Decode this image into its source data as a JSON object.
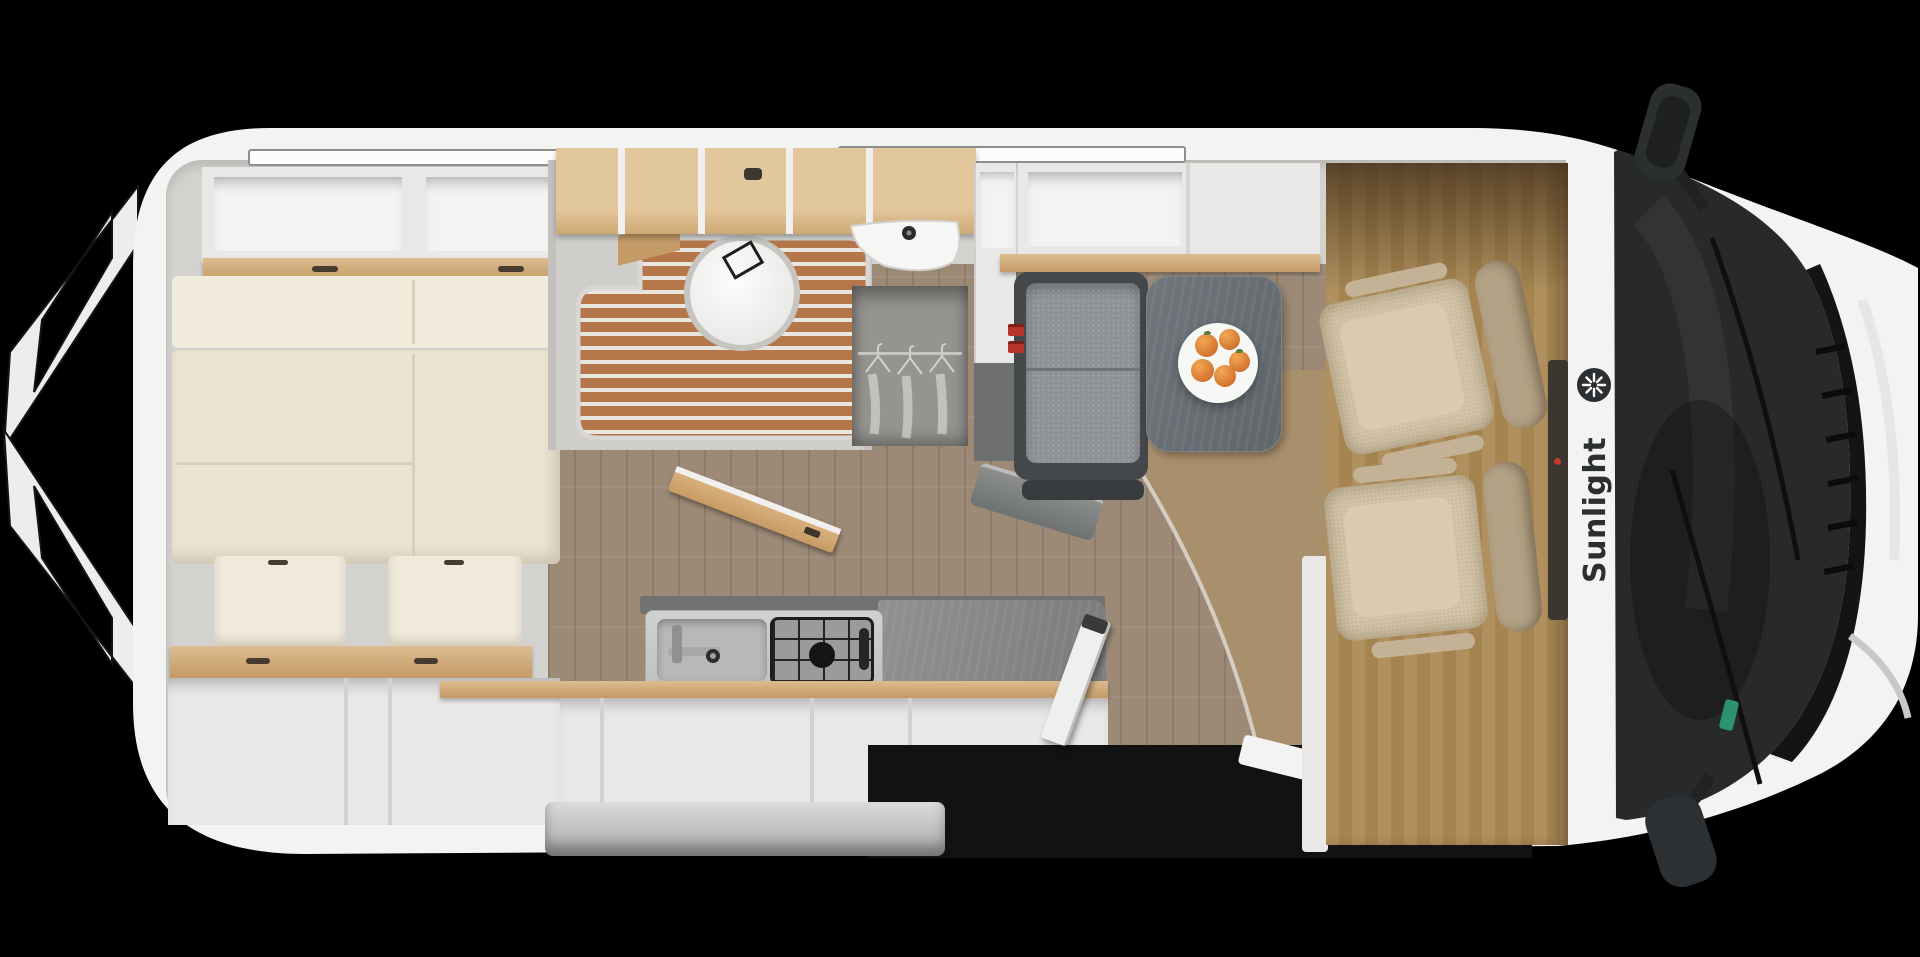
{
  "scene": {
    "title": "Sunlight camper van floor plan - top view",
    "brand": {
      "name": "Sunlight",
      "logo_icon": "sun-star-icon"
    }
  },
  "theme": {
    "bg": "#000000",
    "body": "#f3f3f2",
    "wall": "#d3d2cf",
    "panel": "#e9e8e6",
    "cream": "#ece4d2",
    "wood": "#dcbc8f",
    "slat": "#b5764a",
    "floor": "#9c8a77",
    "floor-warm": "#a9906d",
    "cab": "#bd9c68",
    "seat": "#cfc0a3",
    "glass": "#27292b",
    "bench": "#8f9398",
    "red": "#b8352c",
    "green": "#2f9e77",
    "ink": "#2c2f31",
    "ward": "#96948f"
  },
  "floorplan": {
    "features": [
      "open-rear-doors",
      "rear-bed",
      "overhead-lockers",
      "bathroom-toilet",
      "shower-grate",
      "washbasin",
      "wardrobe",
      "kitchen-sink",
      "gas-hob",
      "fridge-column",
      "dinette-bench",
      "dinette-table",
      "fruit-plate",
      "open-entry-door",
      "entry-step",
      "swivel-cab-seats",
      "windshield",
      "side-mirrors"
    ]
  }
}
